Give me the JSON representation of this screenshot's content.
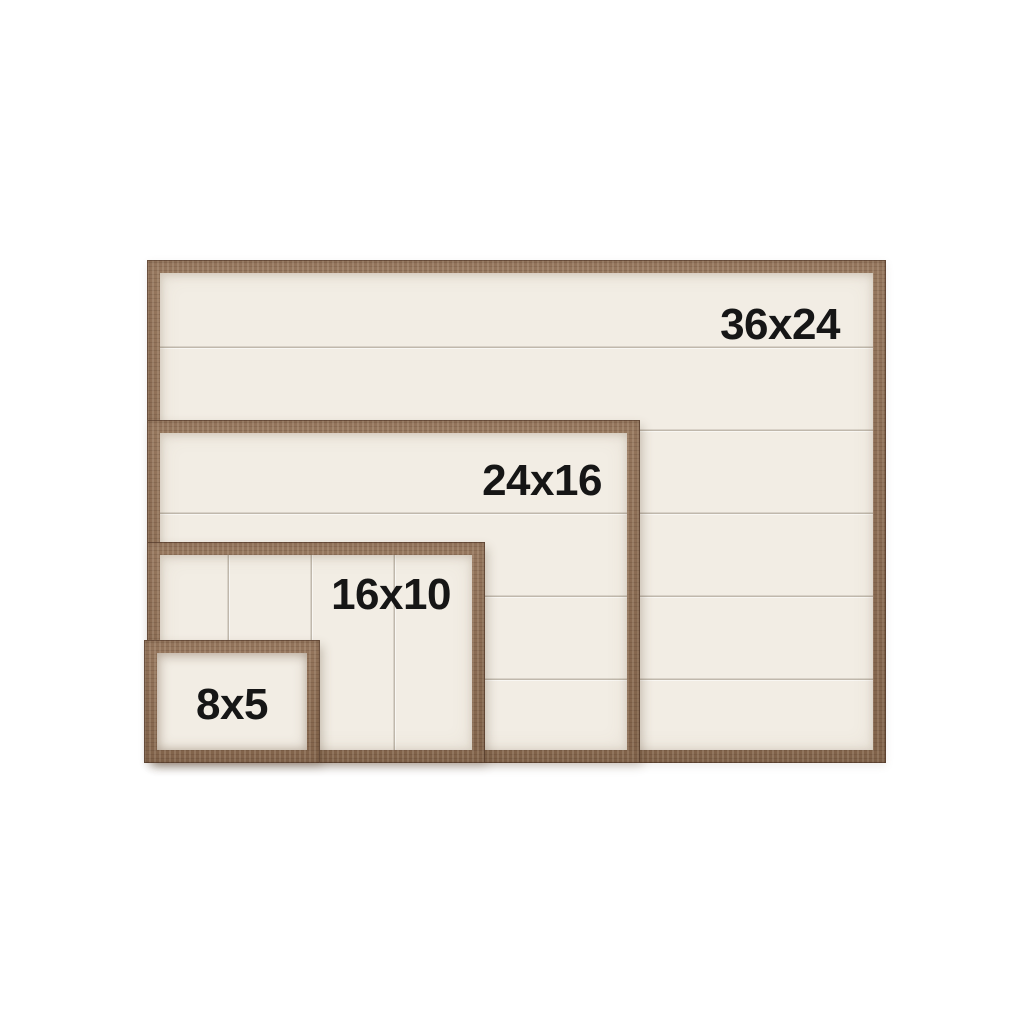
{
  "colors": {
    "page-bg": "#ffffff",
    "wood": "#8d6c51",
    "wood-dark": "#6e4f3a",
    "wood-light": "#ab8c6e",
    "panel": "#f2ede4",
    "seam": "rgba(130,120,104,0.45)",
    "label": "#161616"
  },
  "frames": [
    {
      "label": "36x24",
      "width_in": 36,
      "height_in": 24
    },
    {
      "label": "24x16",
      "width_in": 24,
      "height_in": 16
    },
    {
      "label": "16x10",
      "width_in": 16,
      "height_in": 10
    },
    {
      "label": "8x5",
      "width_in": 8,
      "height_in": 5
    }
  ]
}
